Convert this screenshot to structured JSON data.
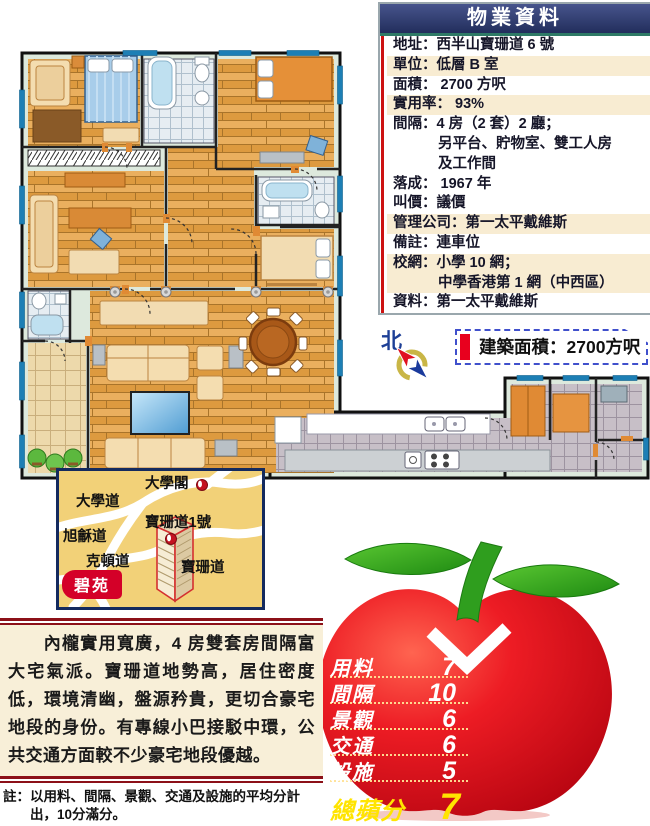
{
  "property_table": {
    "title": "物業資料",
    "lines": [
      "地址：西半山寶珊道 6 號",
      "單位：低層 B 室",
      "面積： 2700 方呎",
      "實用率： 93%",
      "間隔：4 房（2 套）2 廳；",
      "另平台、貯物室、雙工人房",
      "及工作間",
      "落成： 1967 年",
      "叫價：議價",
      "管理公司：第一太平戴維斯",
      "備註：連車位",
      "校網：小學 10 網；",
      "中學香港第 1 網（中西區）",
      "資料：第一太平戴維斯"
    ]
  },
  "north_label": "北",
  "area_badge": "建築面積：2700方呎",
  "map": {
    "labels": [
      "大學閣",
      "大學道",
      "寶珊道1號",
      "旭龢道",
      "克頓道",
      "寶珊道"
    ],
    "estate": "碧苑"
  },
  "apple": {
    "scores": [
      {
        "label": "用料",
        "value": "7"
      },
      {
        "label": "間隔",
        "value": "10"
      },
      {
        "label": "景觀",
        "value": "6"
      },
      {
        "label": "交通",
        "value": "6"
      },
      {
        "label": "設施",
        "value": "5"
      }
    ],
    "total_label": "總蘋分",
    "total_value": "7"
  },
  "review": {
    "paragraph": "內櫳實用寬廣，4 房雙套房間隔富大宅氣派。寶珊道地勢高，居住密度低，環境清幽，盤源矜貴，更切合豪宅地段的身份。有專線小巴接駁中環，公共交通方面較不少豪宅地段優越。",
    "note_prefix": "註：",
    "note": "以用料、間隔、景觀、交通及設施的平均分計出，10分滿分。"
  },
  "colors": {
    "title_bar": "#2a3a6e",
    "row_shade": "#f8ecd2",
    "table_red_line": "#cc1111",
    "badge_red": "#e8001e",
    "badge_border": "#4050cc",
    "map_bg": "#f2d178",
    "map_border": "#142a5e",
    "estate_badge_red": "#d40028",
    "apple_red": "#e30b17",
    "apple_green": "#2f9e1e",
    "total_yellow": "#ffe400",
    "review_bg": "#f8efd8",
    "rule_red": "#8c1018",
    "north_blue": "#1d3f96"
  }
}
